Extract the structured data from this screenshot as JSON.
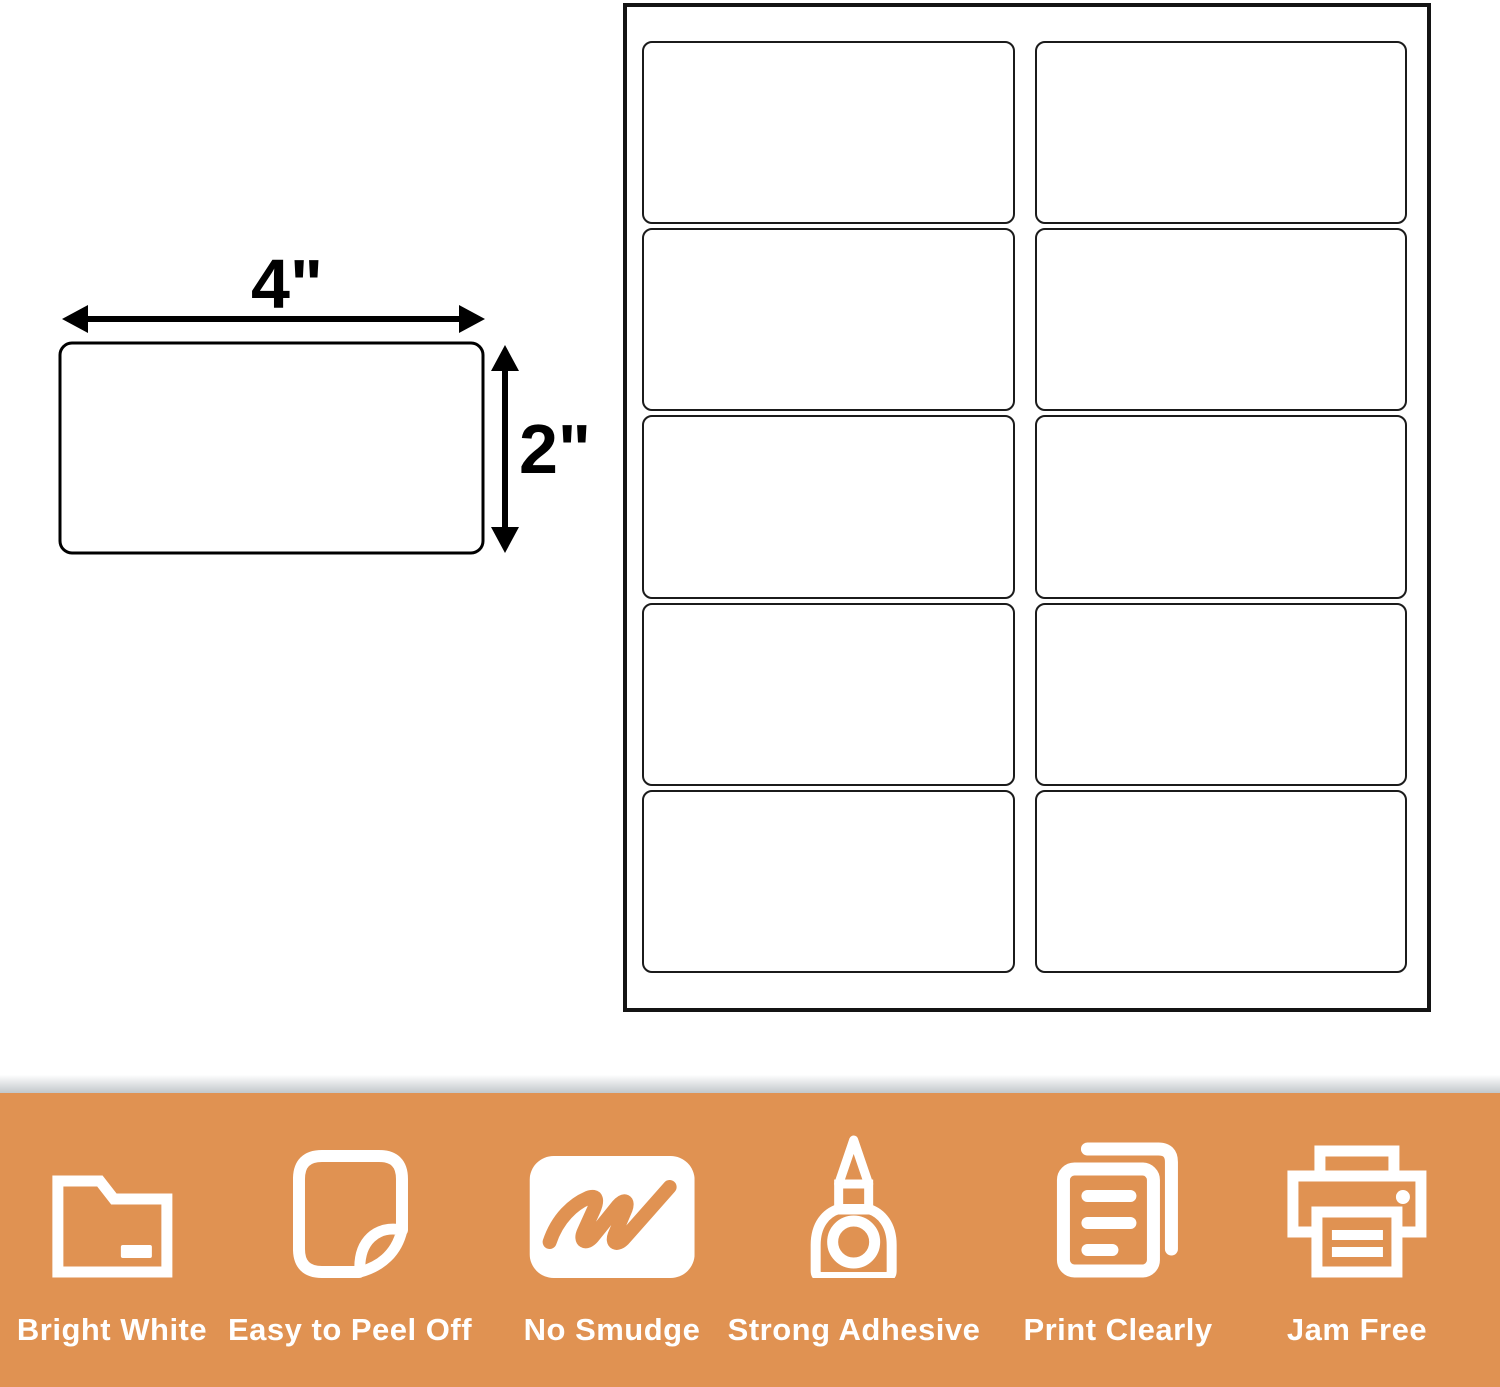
{
  "diagram": {
    "width_label": "4\"",
    "height_label": "2\""
  },
  "sheet": {
    "rows": 5,
    "columns": 2
  },
  "banner": {
    "background_color": "#E09252",
    "icon_color": "#ffffff",
    "features": [
      {
        "icon": "folder-icon",
        "label": "Bright White"
      },
      {
        "icon": "peel-icon",
        "label": "Easy to Peel Off"
      },
      {
        "icon": "scribble-icon",
        "label": "No Smudge"
      },
      {
        "icon": "glue-icon",
        "label": "Strong Adhesive"
      },
      {
        "icon": "pages-icon",
        "label": "Print Clearly"
      },
      {
        "icon": "printer-icon",
        "label": "Jam Free"
      }
    ],
    "feature_centers_px": [
      112,
      350,
      612,
      854,
      1118,
      1357
    ]
  }
}
